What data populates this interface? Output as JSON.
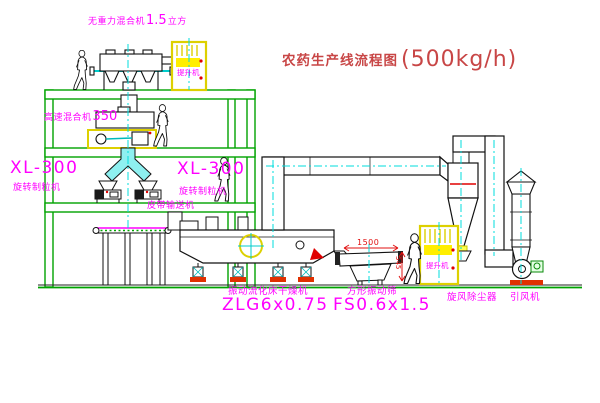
{
  "title": {
    "text": "农药生产线流程图",
    "capacity": "(500kg/h)"
  },
  "labels": {
    "top_mixer": {
      "name": "无重力混合机",
      "num": "1.5",
      "unit": "立方"
    },
    "high_speed_mixer": {
      "name": "高速混合机",
      "num": "350"
    },
    "granulator_left": {
      "model": "XL-300",
      "name": "旋转制粒机"
    },
    "granulator_mid": {
      "model": "XL-300",
      "name": "旋转制粒机"
    },
    "belt_conveyor": "皮带输送机",
    "dryer": {
      "name": "振动流化床干燥机",
      "model": "ZLG6x0.75"
    },
    "screen": {
      "name": "方形振动筛",
      "model": "FS0.6x1.5"
    },
    "cyclone": "旋风除尘器",
    "fan": "引风机",
    "hoist_upper": "提升机",
    "hoist_lower": "提升机",
    "dims": {
      "screen_width": "1500",
      "screen_height": "545"
    }
  },
  "colors": {
    "structure_green": "#00a300",
    "label_magenta": "#ff00ff",
    "title_red": "#c84646",
    "dimension_red": "#e01010",
    "equipment_yellow": "#ddd000",
    "centerline_cyan": "#00dcdc"
  }
}
